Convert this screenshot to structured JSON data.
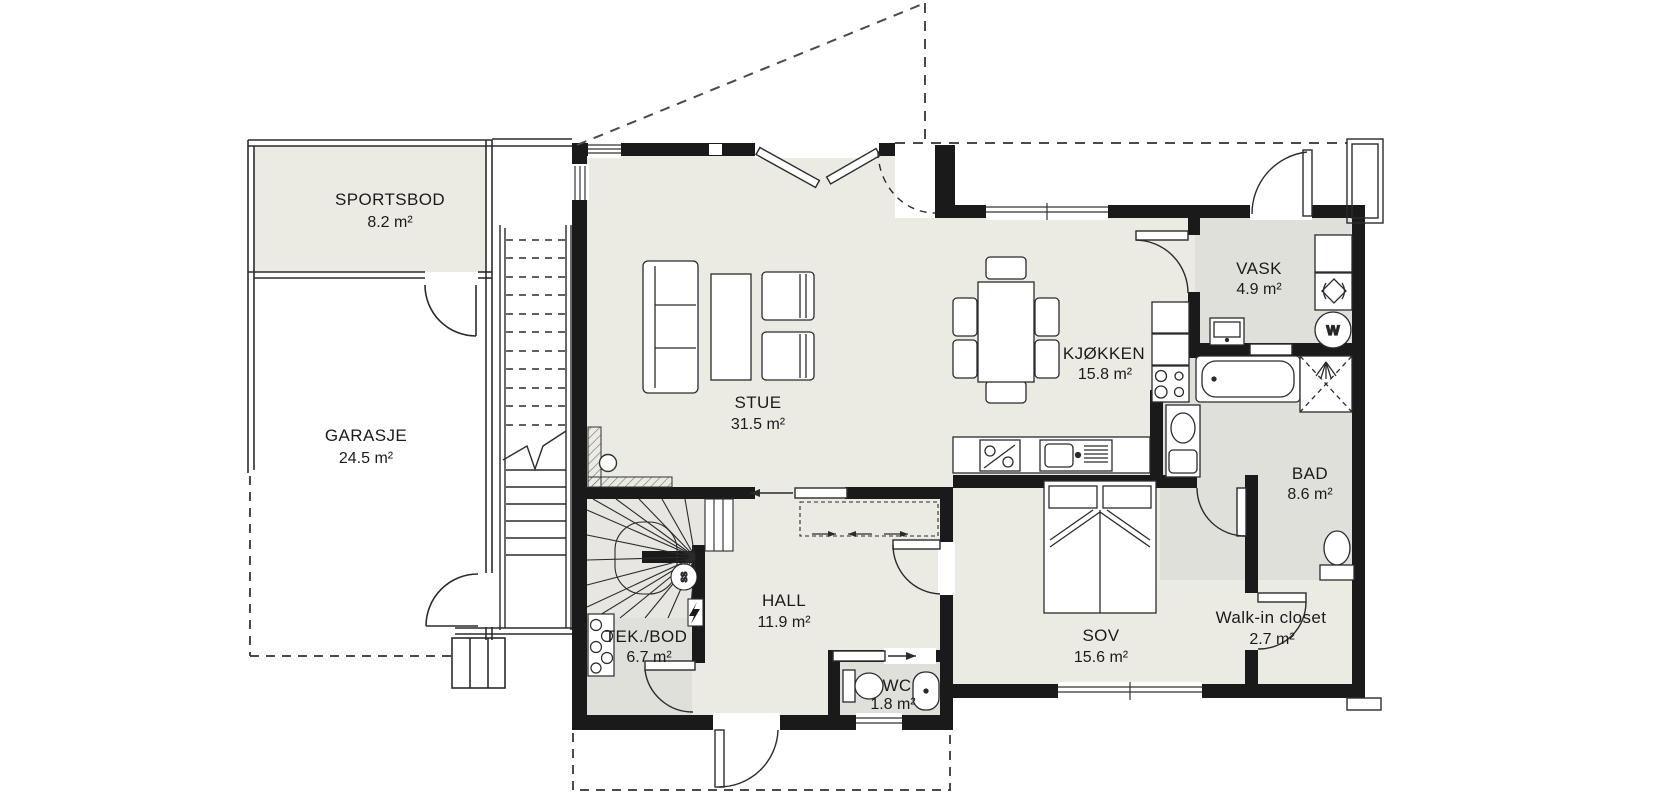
{
  "plan_title": "Floor plan ground floor",
  "rooms": [
    {
      "id": "sportsbod",
      "name": "SPORTSBOD",
      "area": "8.2 m²"
    },
    {
      "id": "garasje",
      "name": "GARASJE",
      "area": "24.5 m²"
    },
    {
      "id": "stue",
      "name": "STUE",
      "area": "31.5 m²"
    },
    {
      "id": "kjokken",
      "name": "KJØKKEN",
      "area": "15.8 m²"
    },
    {
      "id": "vask",
      "name": "VASK",
      "area": "4.9 m²"
    },
    {
      "id": "bad",
      "name": "BAD",
      "area": "8.6 m²"
    },
    {
      "id": "hall",
      "name": "HALL",
      "area": "11.9 m²"
    },
    {
      "id": "tekbod",
      "name": "TEK./BOD",
      "area": "6.7 m²"
    },
    {
      "id": "wc",
      "name": "WC",
      "area": "1.8 m²"
    },
    {
      "id": "sov",
      "name": "SOV",
      "area": "15.6 m²"
    },
    {
      "id": "walkin",
      "name": "Walk-in closet",
      "area": "2.7 m²"
    }
  ],
  "markers": {
    "washer": "W",
    "stair_spindle": "SS"
  },
  "colors": {
    "wall": "#1a1a1a",
    "floor_main": "#ebeae3",
    "floor_wet": "#e0e0db",
    "floor_stair": "#e7e6e0",
    "outline_thin": "#2b2b2b",
    "dash": "#4a4a4a"
  }
}
